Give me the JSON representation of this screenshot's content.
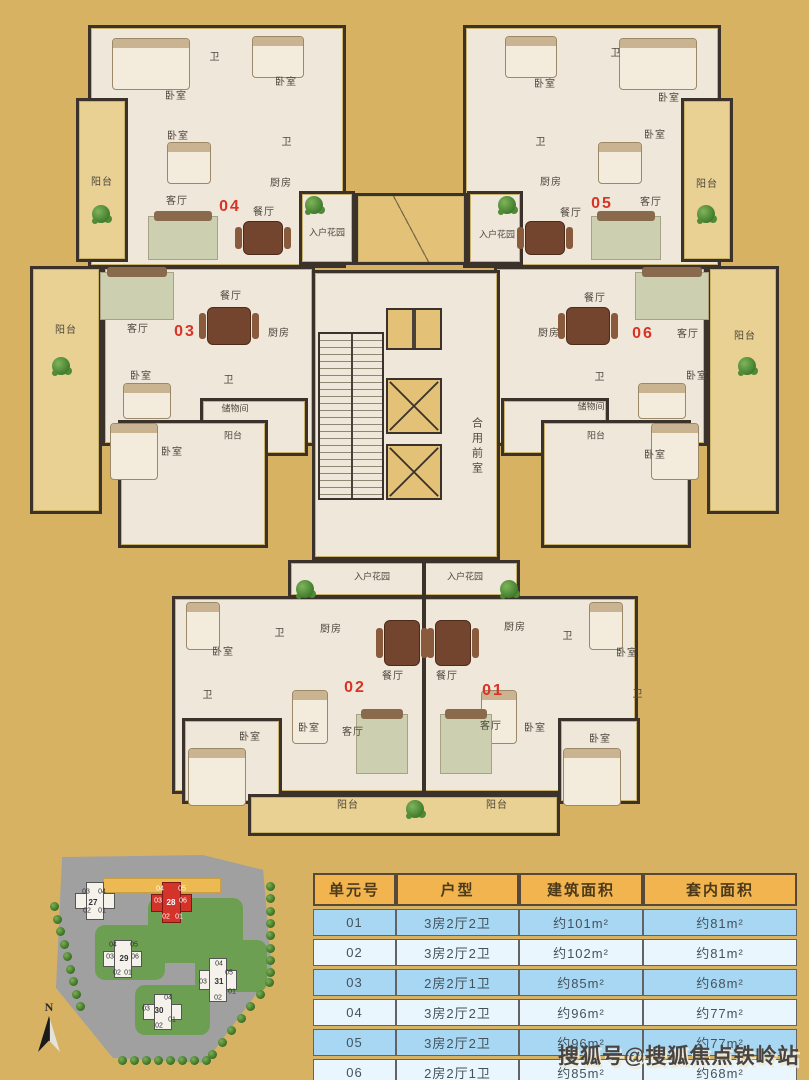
{
  "colors": {
    "background": "#d8b263",
    "unit_number": "#d93226",
    "table_header_bg": "#f1b44f",
    "row_blue": "#a7d7f2",
    "row_light": "#eaf6fd",
    "highlight_building": "#d4332a"
  },
  "floorplan": {
    "labels": [
      {
        "text": "卧室",
        "x": 176,
        "y": 97
      },
      {
        "text": "卧室",
        "x": 286,
        "y": 83
      },
      {
        "text": "卧室",
        "x": 178,
        "y": 137
      },
      {
        "text": "卫",
        "x": 215,
        "y": 58
      },
      {
        "text": "卫",
        "x": 287,
        "y": 143
      },
      {
        "text": "阳台",
        "x": 102,
        "y": 183
      },
      {
        "text": "客厅",
        "x": 177,
        "y": 202
      },
      {
        "text": "厨房",
        "x": 281,
        "y": 184
      },
      {
        "text": "餐厅",
        "x": 264,
        "y": 213
      },
      {
        "text": "04",
        "x": 230,
        "y": 207,
        "kind": "unit"
      },
      {
        "text": "入户花园",
        "x": 327,
        "y": 233,
        "kind": "small"
      },
      {
        "text": "卧室",
        "x": 545,
        "y": 85
      },
      {
        "text": "卧室",
        "x": 669,
        "y": 99
      },
      {
        "text": "卧室",
        "x": 655,
        "y": 136
      },
      {
        "text": "卫",
        "x": 616,
        "y": 54
      },
      {
        "text": "卫",
        "x": 541,
        "y": 143
      },
      {
        "text": "阳台",
        "x": 707,
        "y": 185
      },
      {
        "text": "客厅",
        "x": 651,
        "y": 203
      },
      {
        "text": "厨房",
        "x": 551,
        "y": 183
      },
      {
        "text": "餐厅",
        "x": 571,
        "y": 214
      },
      {
        "text": "05",
        "x": 602,
        "y": 204,
        "kind": "unit"
      },
      {
        "text": "入户花园",
        "x": 497,
        "y": 235,
        "kind": "small"
      },
      {
        "text": "阳台",
        "x": 66,
        "y": 331
      },
      {
        "text": "客厅",
        "x": 138,
        "y": 330
      },
      {
        "text": "03",
        "x": 185,
        "y": 332,
        "kind": "unit"
      },
      {
        "text": "餐厅",
        "x": 231,
        "y": 297
      },
      {
        "text": "厨房",
        "x": 279,
        "y": 334
      },
      {
        "text": "卧室",
        "x": 141,
        "y": 377
      },
      {
        "text": "卫",
        "x": 229,
        "y": 381
      },
      {
        "text": "储物间",
        "x": 235,
        "y": 409,
        "kind": "small"
      },
      {
        "text": "阳台",
        "x": 233,
        "y": 436,
        "kind": "small"
      },
      {
        "text": "卧室",
        "x": 172,
        "y": 453
      },
      {
        "text": "餐厅",
        "x": 595,
        "y": 299
      },
      {
        "text": "厨房",
        "x": 549,
        "y": 334
      },
      {
        "text": "06",
        "x": 643,
        "y": 334,
        "kind": "unit"
      },
      {
        "text": "客厅",
        "x": 688,
        "y": 335
      },
      {
        "text": "阳台",
        "x": 745,
        "y": 337
      },
      {
        "text": "卫",
        "x": 600,
        "y": 378
      },
      {
        "text": "卧室",
        "x": 697,
        "y": 377
      },
      {
        "text": "储物间",
        "x": 591,
        "y": 407,
        "kind": "small"
      },
      {
        "text": "阳台",
        "x": 596,
        "y": 436,
        "kind": "small"
      },
      {
        "text": "卧室",
        "x": 655,
        "y": 456
      },
      {
        "text": "合用前室",
        "x": 476,
        "y": 447,
        "kind": "vert"
      },
      {
        "text": "入户花园",
        "x": 372,
        "y": 577,
        "kind": "small"
      },
      {
        "text": "入户花园",
        "x": 465,
        "y": 577,
        "kind": "small"
      },
      {
        "text": "厨房",
        "x": 331,
        "y": 630
      },
      {
        "text": "卫",
        "x": 280,
        "y": 634
      },
      {
        "text": "卧室",
        "x": 223,
        "y": 653
      },
      {
        "text": "餐厅",
        "x": 393,
        "y": 677
      },
      {
        "text": "02",
        "x": 355,
        "y": 688,
        "kind": "unit"
      },
      {
        "text": "卫",
        "x": 208,
        "y": 696
      },
      {
        "text": "卧室",
        "x": 309,
        "y": 729
      },
      {
        "text": "客厅",
        "x": 353,
        "y": 733
      },
      {
        "text": "卧室",
        "x": 250,
        "y": 738
      },
      {
        "text": "阳台",
        "x": 348,
        "y": 806
      },
      {
        "text": "厨房",
        "x": 515,
        "y": 628
      },
      {
        "text": "卫",
        "x": 568,
        "y": 637
      },
      {
        "text": "卧室",
        "x": 627,
        "y": 654
      },
      {
        "text": "餐厅",
        "x": 447,
        "y": 677
      },
      {
        "text": "01",
        "x": 493,
        "y": 691,
        "kind": "unit"
      },
      {
        "text": "卫",
        "x": 638,
        "y": 695
      },
      {
        "text": "客厅",
        "x": 491,
        "y": 727
      },
      {
        "text": "卧室",
        "x": 535,
        "y": 729
      },
      {
        "text": "卧室",
        "x": 600,
        "y": 740
      },
      {
        "text": "阳台",
        "x": 497,
        "y": 806
      }
    ]
  },
  "site_plan": {
    "compass_label": "N",
    "buildings": [
      {
        "number": "27",
        "highlight": false,
        "box": [
          72,
          880,
          46,
          42
        ],
        "number_pos": [
          93,
          903
        ],
        "units": [
          {
            "n": "03",
            "x": 86,
            "y": 892
          },
          {
            "n": "04",
            "x": 102,
            "y": 892
          },
          {
            "n": "02",
            "x": 87,
            "y": 911
          },
          {
            "n": "01",
            "x": 102,
            "y": 911
          }
        ]
      },
      {
        "number": "28",
        "highlight": true,
        "box": [
          148,
          880,
          47,
          45
        ],
        "number_pos": [
          171,
          903
        ],
        "units": [
          {
            "n": "04",
            "x": 160,
            "y": 889
          },
          {
            "n": "05",
            "x": 182,
            "y": 889
          },
          {
            "n": "03",
            "x": 158,
            "y": 901
          },
          {
            "n": "06",
            "x": 183,
            "y": 901
          },
          {
            "n": "02",
            "x": 166,
            "y": 917
          },
          {
            "n": "01",
            "x": 179,
            "y": 917
          }
        ]
      },
      {
        "number": "29",
        "highlight": false,
        "box": [
          100,
          938,
          45,
          42
        ],
        "number_pos": [
          124,
          959
        ],
        "units": [
          {
            "n": "04",
            "x": 113,
            "y": 945
          },
          {
            "n": "05",
            "x": 134,
            "y": 945
          },
          {
            "n": "03",
            "x": 110,
            "y": 957
          },
          {
            "n": "06",
            "x": 135,
            "y": 957
          },
          {
            "n": "02",
            "x": 117,
            "y": 973
          },
          {
            "n": "01",
            "x": 128,
            "y": 973
          }
        ]
      },
      {
        "number": "30",
        "highlight": false,
        "box": [
          140,
          992,
          45,
          40
        ],
        "number_pos": [
          159,
          1011
        ],
        "units": [
          {
            "n": "04",
            "x": 168,
            "y": 998
          },
          {
            "n": "03",
            "x": 146,
            "y": 1009
          },
          {
            "n": "01",
            "x": 172,
            "y": 1020
          },
          {
            "n": "02",
            "x": 159,
            "y": 1026
          }
        ]
      },
      {
        "number": "31",
        "highlight": false,
        "box": [
          196,
          956,
          44,
          48
        ],
        "number_pos": [
          219,
          982
        ],
        "units": [
          {
            "n": "04",
            "x": 219,
            "y": 964
          },
          {
            "n": "05",
            "x": 229,
            "y": 973
          },
          {
            "n": "03",
            "x": 203,
            "y": 982
          },
          {
            "n": "01",
            "x": 232,
            "y": 992
          },
          {
            "n": "02",
            "x": 218,
            "y": 998
          }
        ]
      }
    ]
  },
  "table": {
    "headers": [
      "单元号",
      "户型",
      "建筑面积",
      "套内面积"
    ],
    "rows": [
      [
        "01",
        "3房2厅2卫",
        "约101m²",
        "约81m²"
      ],
      [
        "02",
        "3房2厅2卫",
        "约102m²",
        "约81m²"
      ],
      [
        "03",
        "2房2厅1卫",
        "约85m²",
        "约68m²"
      ],
      [
        "04",
        "3房2厅2卫",
        "约96m²",
        "约77m²"
      ],
      [
        "05",
        "3房2厅2卫",
        "约96m²",
        "约77m²"
      ],
      [
        "06",
        "2房2厅1卫",
        "约85m²",
        "约68m²"
      ]
    ]
  },
  "watermark": "搜狐号@搜狐焦点铁岭站"
}
